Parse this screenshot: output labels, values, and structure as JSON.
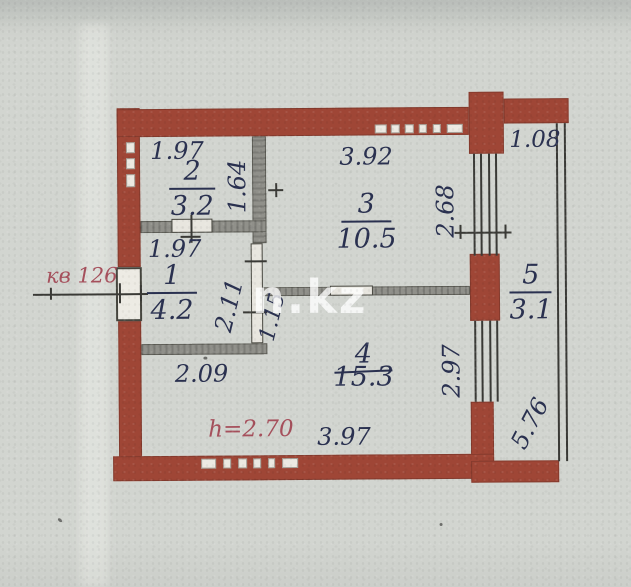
{
  "plan": {
    "apartment_label": "кв 126",
    "height_note": "h=2.70",
    "watermark": "n.kz",
    "rooms": [
      {
        "number": "1",
        "area": "4.2"
      },
      {
        "number": "2",
        "area": "3.2"
      },
      {
        "number": "3",
        "area": "10.5"
      },
      {
        "number": "4",
        "area": "15.3"
      },
      {
        "number": "5",
        "area": "3.1"
      }
    ],
    "dimensions": {
      "top_left_width": "1.97",
      "top_center_width": "3.92",
      "balcony_width": "1.08",
      "room2_depth": "1.64",
      "room3_window": "2.68",
      "room1_width": "1.97",
      "room1_depth": "2.11",
      "door_opening": "1.15",
      "hall_width": "2.09",
      "room4_window": "2.97",
      "room4_width": "3.97",
      "balcony_length": "5.76"
    },
    "colors": {
      "outer_wall": "#9f4636",
      "interior_wall": "#90908a",
      "ink": "#2a3150",
      "red_ink": "#a6505c",
      "paper": "#d2d5d0"
    }
  }
}
